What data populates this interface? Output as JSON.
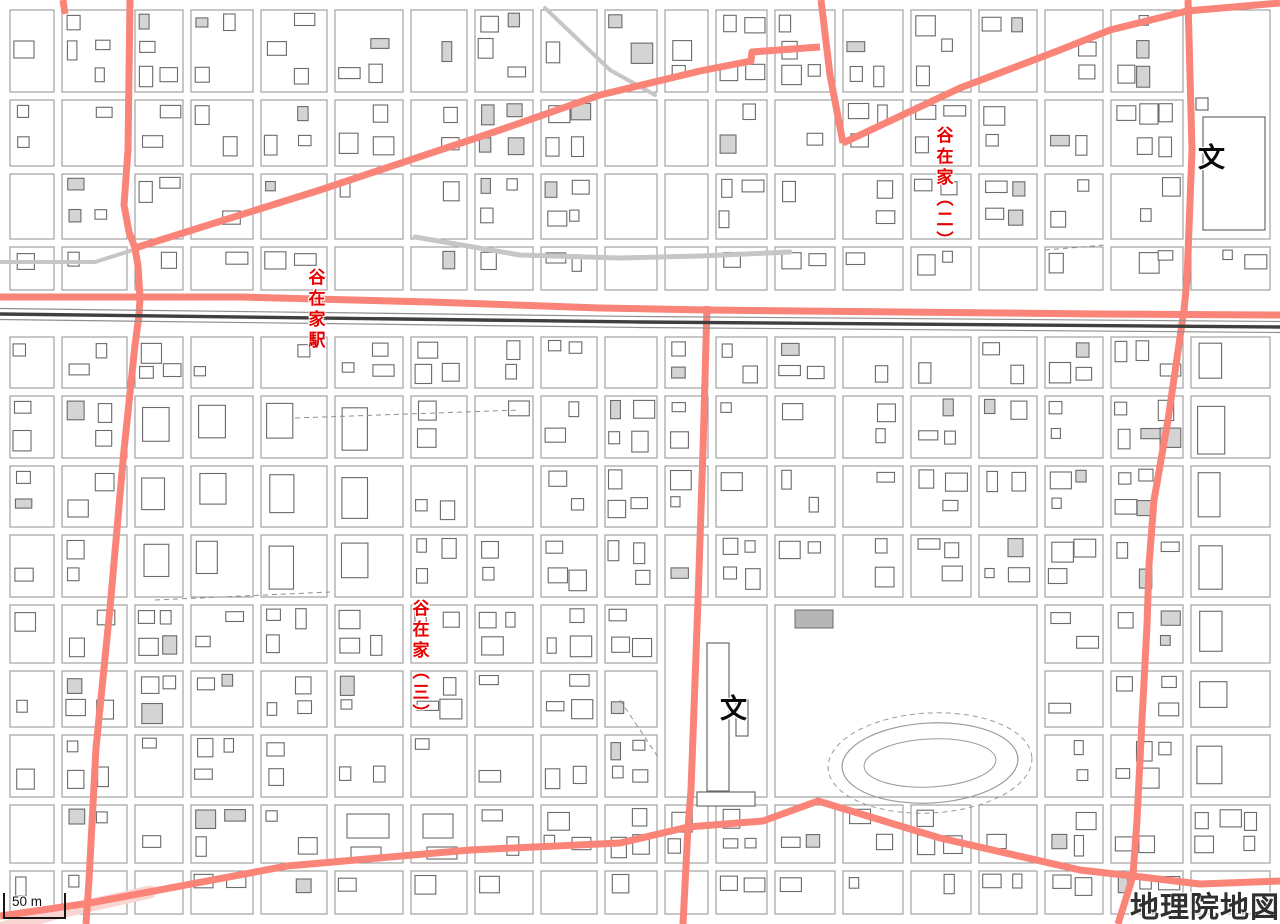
{
  "map": {
    "attribution": {
      "label": "地理院地図"
    },
    "scale_bar": {
      "label": "50 m"
    },
    "place_labels": [
      {
        "name": "station-label",
        "text": "谷在家駅",
        "x": 316,
        "y": 268,
        "writing": "vertical",
        "font_size": 17
      },
      {
        "name": "district-label-yazaike-2",
        "text": "谷在家（二）",
        "x": 944,
        "y": 126,
        "writing": "vertical",
        "font_size": 17
      },
      {
        "name": "district-label-yazaike-3",
        "text": "谷在家（三）",
        "x": 420,
        "y": 599,
        "writing": "vertical",
        "font_size": 17
      }
    ],
    "school_symbols": [
      {
        "glyph": "文",
        "x": 734,
        "y": 711
      },
      {
        "glyph": "文",
        "x": 1212,
        "y": 160
      }
    ],
    "colors": {
      "major_road": "#fa8478",
      "major_road_light": "#f9d6d2",
      "label_red": "#e60000",
      "railway_dark": "#3f3f3f",
      "railway_thin": "#8f8f8f",
      "street_gray": "#8f8f8f",
      "gray_road": "#c6c6c6",
      "building_stroke": "#6a6a6a",
      "building_fill": "#ffffff",
      "building_fill_alt": "#d4d4d4",
      "solid_building_fill": "#b5b5b5"
    },
    "geometry": {
      "width": 1280,
      "height": 924,
      "seed": 42,
      "major_road_width": 7,
      "major_roads": [
        {
          "name": "main-ew-road",
          "points": [
            [
              0,
              297
            ],
            [
              240,
              297
            ],
            [
              430,
              302
            ],
            [
              600,
              308
            ],
            [
              707,
              310
            ],
            [
              900,
              312
            ],
            [
              1100,
              314
            ],
            [
              1280,
              315
            ]
          ]
        },
        {
          "name": "left-street-north",
          "points": [
            [
              130,
              0
            ],
            [
              128,
              150
            ],
            [
              124,
              205
            ],
            [
              129,
              232
            ],
            [
              135,
              248
            ]
          ]
        },
        {
          "name": "left-street-south",
          "points": [
            [
              135,
              248
            ],
            [
              138,
              266
            ],
            [
              140,
              298
            ],
            [
              139,
              315
            ],
            [
              135,
              345
            ],
            [
              124,
              450
            ],
            [
              110,
              608
            ],
            [
              96,
              748
            ],
            [
              89,
              880
            ],
            [
              86,
              924
            ]
          ]
        },
        {
          "name": "diagonal-road-west",
          "points": [
            [
              135,
              248
            ],
            [
              320,
              190
            ],
            [
              500,
              130
            ],
            [
              600,
              95
            ],
            [
              700,
              71
            ],
            [
              751,
              61
            ],
            [
              752,
              52
            ],
            [
              820,
              47
            ]
          ]
        },
        {
          "name": "north-vertical-road",
          "points": [
            [
              821,
              0
            ],
            [
              830,
              75
            ],
            [
              843,
              143
            ]
          ]
        },
        {
          "name": "diagonal-road-east",
          "points": [
            [
              843,
              143
            ],
            [
              960,
              88
            ],
            [
              1060,
              50
            ],
            [
              1110,
              30
            ],
            [
              1187,
              11
            ],
            [
              1280,
              3
            ]
          ]
        },
        {
          "name": "right-main-street",
          "points": [
            [
              1188,
              0
            ],
            [
              1192,
              150
            ],
            [
              1187,
              280
            ],
            [
              1184,
              310
            ],
            [
              1176,
              365
            ],
            [
              1168,
              420
            ],
            [
              1154,
              500
            ],
            [
              1149,
              565
            ],
            [
              1147,
              625
            ],
            [
              1142,
              720
            ],
            [
              1137,
              820
            ],
            [
              1133,
              875
            ]
          ]
        },
        {
          "name": "center-vertical-street",
          "points": [
            [
              707,
              306
            ],
            [
              703,
              450
            ],
            [
              698,
              600
            ],
            [
              691,
              790
            ],
            [
              688,
              827
            ],
            [
              683,
              924
            ]
          ]
        },
        {
          "name": "bottom-road",
          "points": [
            [
              0,
              916
            ],
            [
              90,
              903
            ],
            [
              287,
              866
            ],
            [
              470,
              850
            ],
            [
              620,
              843
            ],
            [
              688,
              827
            ],
            [
              763,
              821
            ],
            [
              818,
              801
            ],
            [
              940,
              838
            ],
            [
              1080,
              870
            ],
            [
              1133,
              876
            ]
          ]
        },
        {
          "name": "bottom-right-east",
          "points": [
            [
              1133,
              876
            ],
            [
              1200,
              884
            ],
            [
              1280,
              881
            ]
          ]
        },
        {
          "name": "bottom-right-south",
          "points": [
            [
              1133,
              876
            ],
            [
              1118,
              924
            ]
          ]
        },
        {
          "name": "top-left-stub",
          "points": [
            [
              63,
              0
            ],
            [
              65,
              14
            ]
          ]
        }
      ],
      "light_band": {
        "points": [
          [
            -12,
            932
          ],
          [
            60,
            912
          ],
          [
            150,
            892
          ]
        ],
        "width": 13
      },
      "railway": {
        "points": [
          [
            0,
            314
          ],
          [
            640,
            322
          ],
          [
            1280,
            327
          ]
        ],
        "offsets": [
          -5.5,
          5.5
        ]
      },
      "gray_roads": [
        {
          "points": [
            [
              415,
              237
            ],
            [
              520,
              255
            ],
            [
              620,
              258
            ],
            [
              700,
              256
            ],
            [
              790,
              252
            ]
          ],
          "width": 5
        },
        {
          "points": [
            [
              0,
              262
            ],
            [
              95,
              262
            ],
            [
              133,
              250
            ]
          ],
          "width": 4
        },
        {
          "points": [
            [
              545,
              8
            ],
            [
              610,
              70
            ],
            [
              655,
              95
            ]
          ],
          "width": 4
        }
      ],
      "dashed_paths": [
        {
          "points": [
            [
              295,
              418
            ],
            [
              520,
              410
            ]
          ]
        },
        {
          "points": [
            [
              155,
              600
            ],
            [
              330,
              592
            ]
          ]
        },
        {
          "points": [
            [
              1045,
              250
            ],
            [
              1105,
              245
            ]
          ]
        },
        {
          "points": [
            [
              620,
              700
            ],
            [
              660,
              760
            ]
          ]
        }
      ],
      "grid_x": [
        6,
        58,
        131,
        187,
        257,
        331,
        407,
        471,
        537,
        601,
        661,
        712,
        771,
        839,
        907,
        975,
        1041,
        1107,
        1187,
        1274
      ],
      "grid_y_above": [
        6,
        96,
        170,
        243,
        294
      ],
      "grid_y_below": [
        333,
        392,
        462,
        531,
        601,
        667,
        731,
        801,
        867,
        918
      ],
      "zones": [
        {
          "type": "empty",
          "x1": 601,
          "y1": 96,
          "x2": 712,
          "y2": 243
        },
        {
          "type": "park",
          "x1": 771,
          "y1": 601,
          "x2": 1041,
          "y2": 801
        },
        {
          "type": "school",
          "x1": 661,
          "y1": 601,
          "x2": 771,
          "y2": 801
        },
        {
          "type": "school2",
          "x1": 1187,
          "y1": 6,
          "x2": 1274,
          "y2": 243
        },
        {
          "type": "danchi",
          "x1": 131,
          "y1": 392,
          "x2": 407,
          "y2": 601
        },
        {
          "type": "danchi",
          "x1": 1187,
          "y1": 333,
          "x2": 1274,
          "y2": 801
        },
        {
          "type": "bigbuilding",
          "x1": 331,
          "y1": 801,
          "x2": 471,
          "y2": 867
        }
      ],
      "park_oval": {
        "cx": 930,
        "cy": 763,
        "rx": 88,
        "ry": 40,
        "rx2": 66,
        "ry2": 24,
        "rx3": 102,
        "ry3": 50
      },
      "school_buildings": [
        {
          "x": 707,
          "y": 643,
          "w": 22,
          "h": 148
        },
        {
          "x": 736,
          "y": 700,
          "w": 12,
          "h": 36
        },
        {
          "x": 697,
          "y": 792,
          "w": 58,
          "h": 14
        },
        {
          "x": 1203,
          "y": 117,
          "w": 62,
          "h": 113
        },
        {
          "x": 1196,
          "y": 98,
          "w": 12,
          "h": 12
        }
      ],
      "solid_buildings": [
        {
          "x": 795,
          "y": 610,
          "w": 38,
          "h": 18
        }
      ],
      "boundary_rects": [
        {
          "x1": 775,
          "y1": 605,
          "x2": 1037,
          "y2": 797
        },
        {
          "x1": 665,
          "y1": 605,
          "x2": 767,
          "y2": 797
        },
        {
          "x1": 1191,
          "y1": 10,
          "x2": 1270,
          "y2": 239
        }
      ]
    }
  }
}
